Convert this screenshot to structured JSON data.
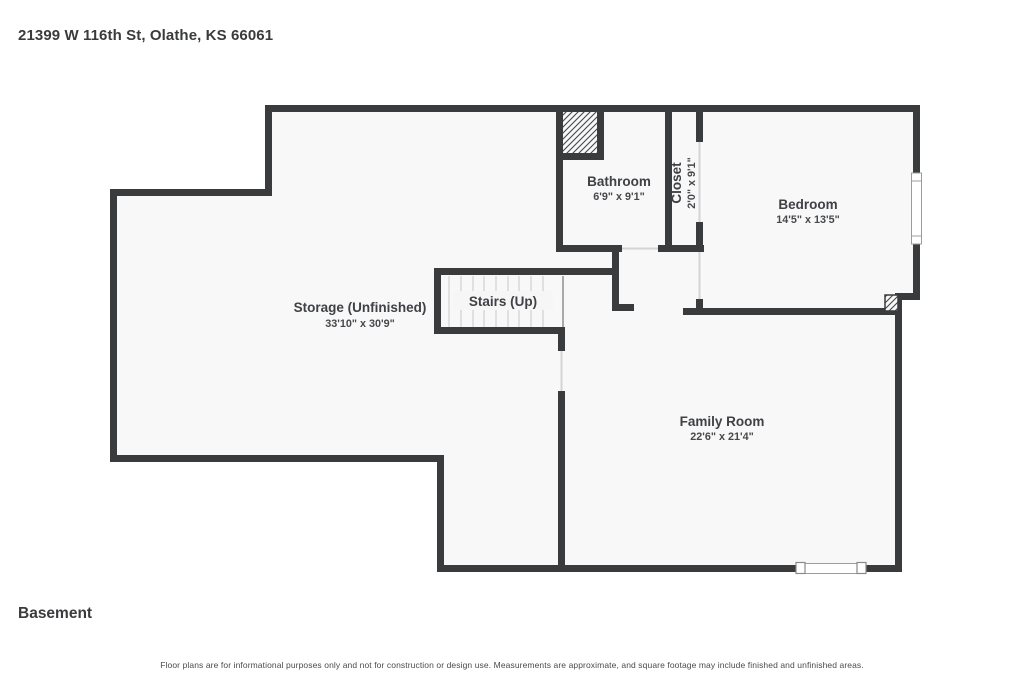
{
  "header": {
    "address": "21399 W 116th St, Olathe, KS 66061"
  },
  "floor_label": "Basement",
  "disclaimer": "Floor plans are for informational purposes only and not for construction or design use. Measurements are approximate, and square footage may include finished and unfinished areas.",
  "rooms": {
    "bathroom": {
      "name": "Bathroom",
      "dims": "6'9\" x 9'1\""
    },
    "closet": {
      "name": "Closet",
      "dims": "2'0\" x 9'1\""
    },
    "bedroom": {
      "name": "Bedroom",
      "dims": "14'5\" x 13'5\""
    },
    "storage": {
      "name": "Storage (Unfinished)",
      "dims": "33'10\" x 30'9\""
    },
    "stairs": {
      "name": "Stairs (Up)"
    },
    "family_room": {
      "name": "Family Room",
      "dims": "22'6\" x 21'4\""
    }
  },
  "colors": {
    "wall": "#3a3b3d",
    "floor": "#f8f8f8",
    "text": "#3f4145"
  }
}
